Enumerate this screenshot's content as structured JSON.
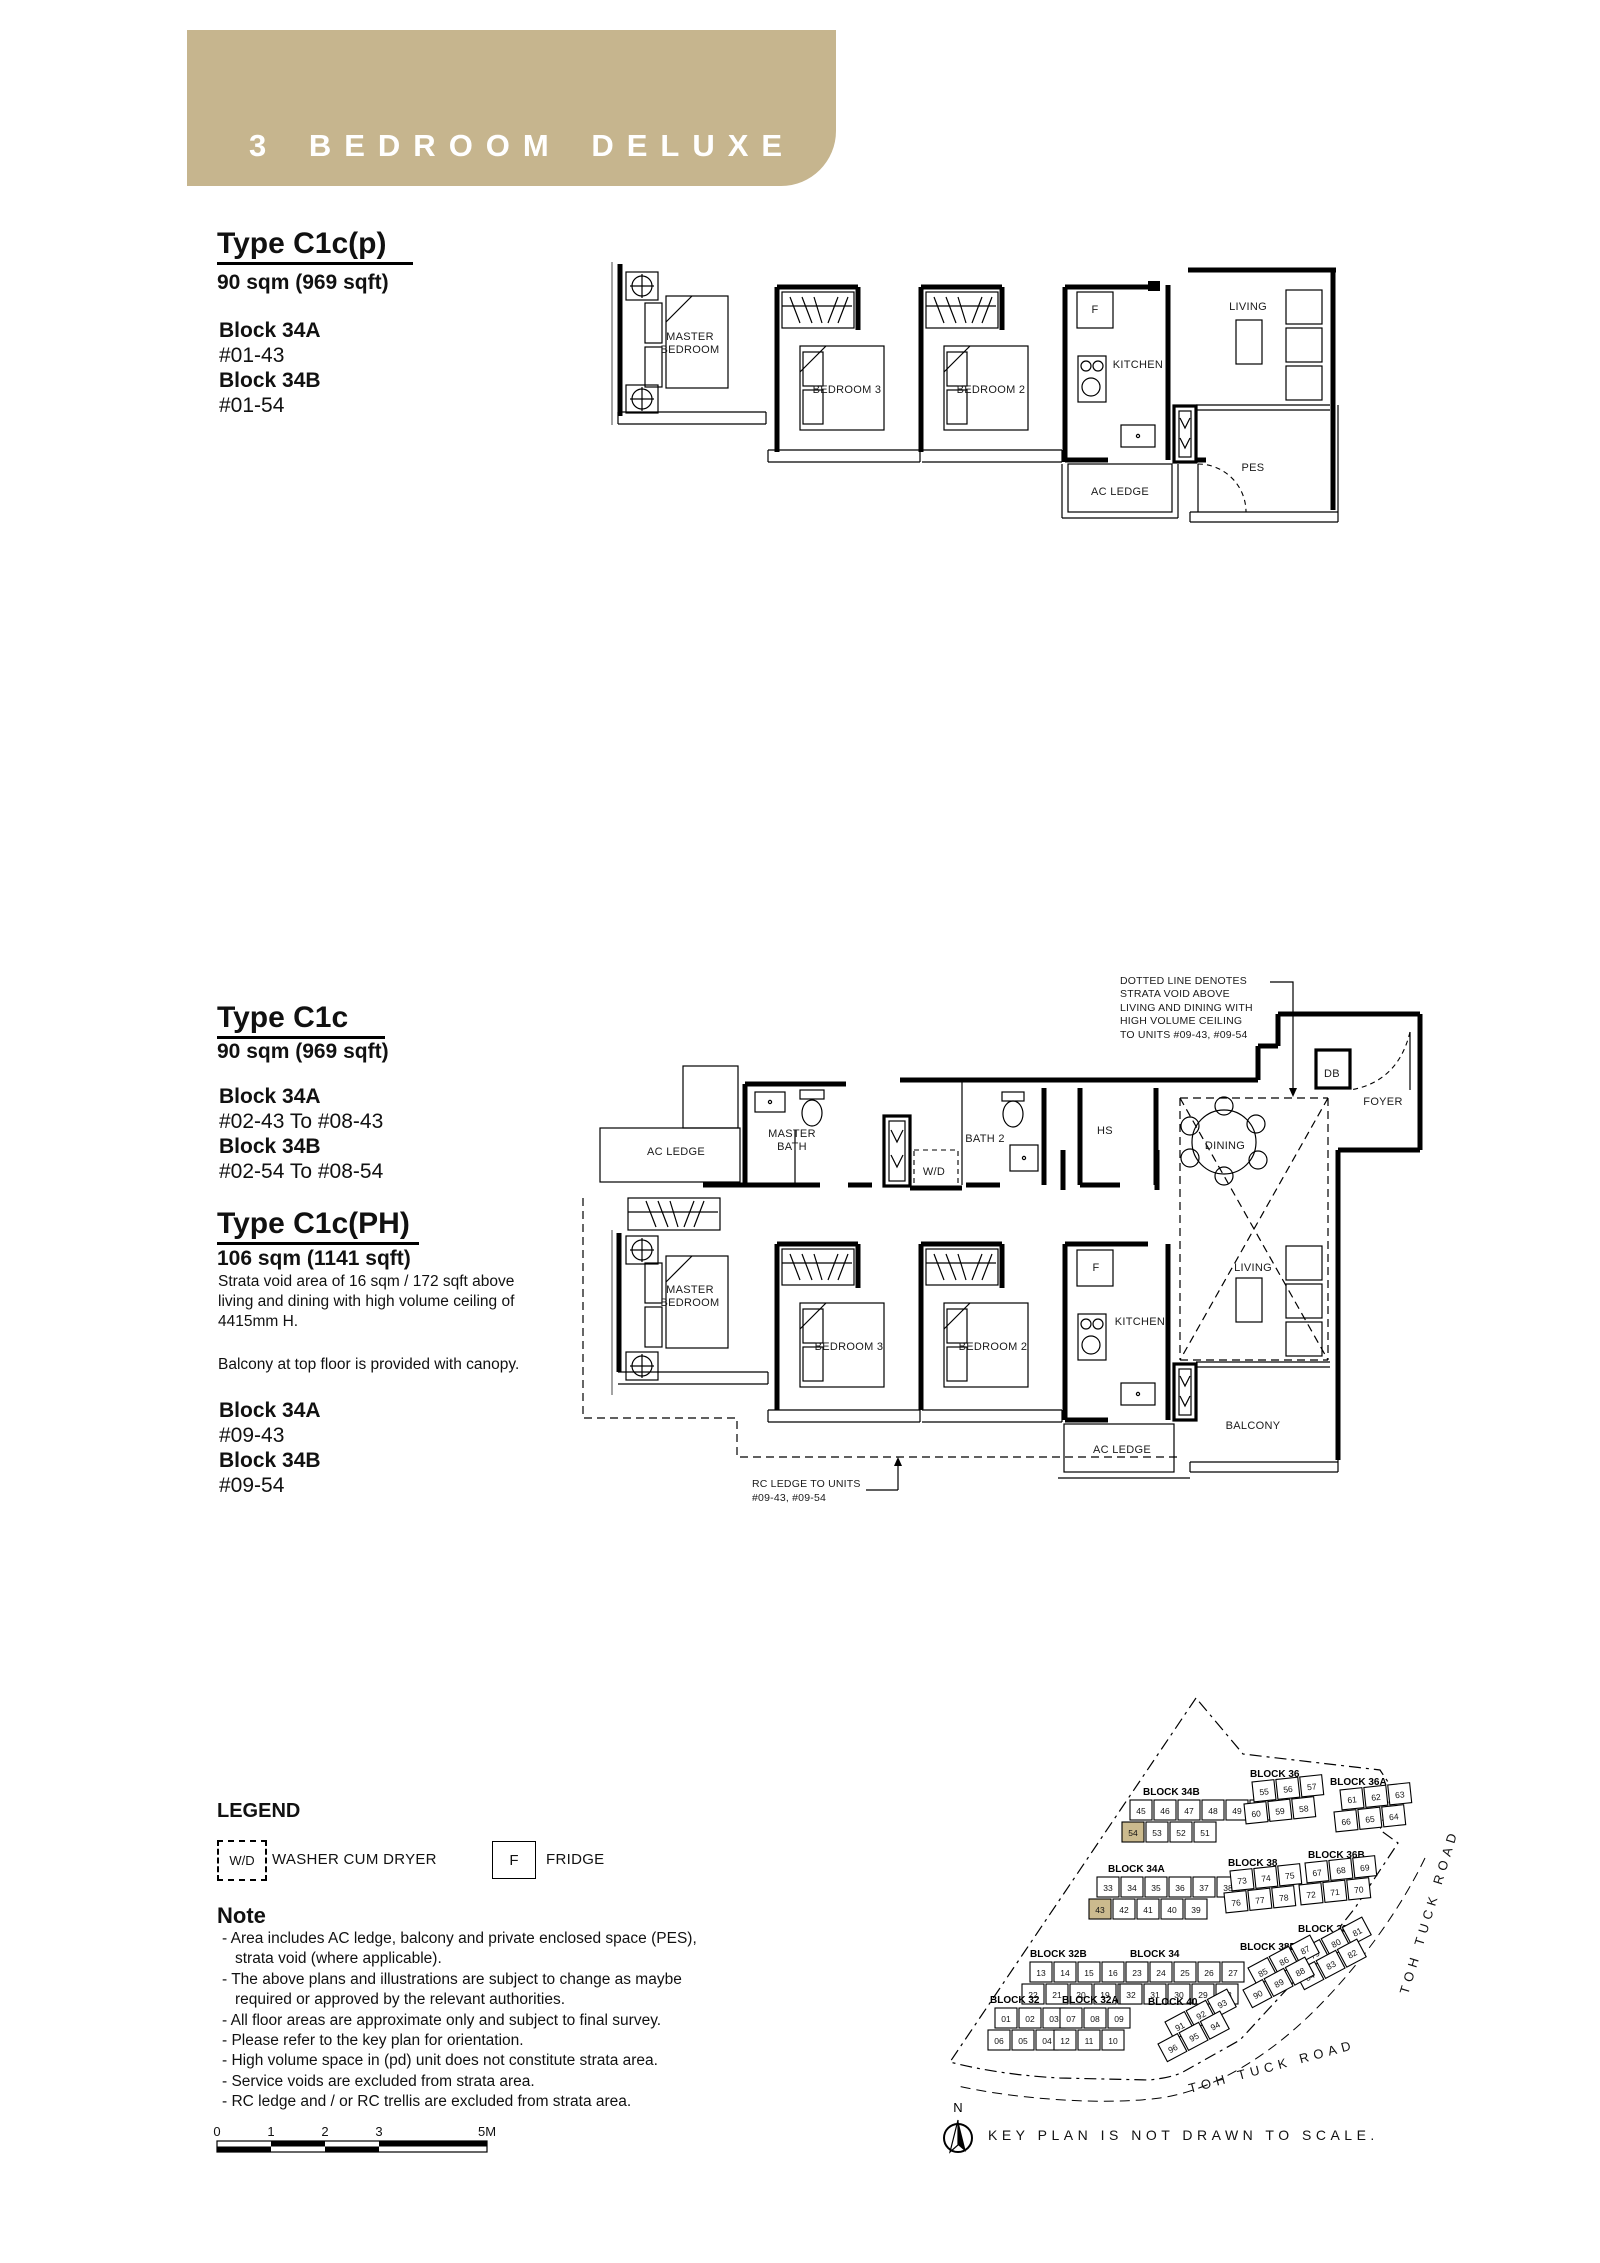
{
  "banner": {
    "title": "3 BEDROOM DELUXE"
  },
  "colors": {
    "banner": "#c6b58e",
    "highlight": "#cbba8e"
  },
  "unit_c1cp": {
    "title": "Type C1c(p)",
    "area": "90 sqm (969 sqft)",
    "stack": [
      {
        "block": "Block 34A",
        "units": "#01-43"
      },
      {
        "block": "Block 34B",
        "units": "#01-54"
      }
    ]
  },
  "unit_c1c": {
    "title": "Type C1c",
    "area": "90 sqm (969 sqft)",
    "stack": [
      {
        "block": "Block 34A",
        "units": "#02-43 To #08-43"
      },
      {
        "block": "Block 34B",
        "units": "#02-54 To #08-54"
      }
    ]
  },
  "unit_c1cph": {
    "title": "Type C1c(PH)",
    "area": "106 sqm (1141 sqft)",
    "desc": [
      "Strata void area of 16 sqm / 172 sqft above",
      "living and dining with high volume ceiling of",
      "4415mm H."
    ],
    "canopy_note": "Balcony at top floor is provided with canopy.",
    "stack": [
      {
        "block": "Block 34A",
        "units": "#09-43"
      },
      {
        "block": "Block 34B",
        "units": "#09-54"
      }
    ]
  },
  "plan1": {
    "labels": {
      "master_bedroom": "MASTER BEDROOM",
      "bedroom3": "BEDROOM 3",
      "bedroom2": "BEDROOM 2",
      "fridge": "F",
      "kitchen": "KITCHEN",
      "living": "LIVING",
      "pes": "PES",
      "ac_ledge": "AC LEDGE"
    }
  },
  "plan2": {
    "labels": {
      "ac_ledge_top": "AC LEDGE",
      "master_bath": "MASTER BATH",
      "wd": "W/D",
      "bath2": "BATH 2",
      "hs": "HS",
      "dining": "DINING",
      "db": "DB",
      "foyer": "FOYER",
      "master_bedroom": "MASTER BEDROOM",
      "bedroom3": "BEDROOM 3",
      "bedroom2": "BEDROOM 2",
      "fridge": "F",
      "kitchen": "KITCHEN",
      "living": "LIVING",
      "balcony": "BALCONY",
      "ac_ledge_bottom": "AC LEDGE"
    },
    "strata_note": [
      "DOTTED LINE DENOTES",
      "STRATA VOID ABOVE",
      "LIVING AND DINING WITH",
      "HIGH VOLUME CEILING",
      "TO UNITS #09-43, #09-54"
    ],
    "rc_note": [
      "RC LEDGE TO UNITS",
      "#09-43, #09-54"
    ]
  },
  "legend": {
    "title": "LEGEND",
    "wd_symbol": "W/D",
    "wd_label": "WASHER CUM DRYER",
    "f_symbol": "F",
    "f_label": "FRIDGE"
  },
  "note": {
    "title": "Note",
    "lines": [
      "- Area includes AC ledge, balcony and private enclosed space (PES),",
      "strata void (where applicable).",
      "- The above plans and illustrations are subject to change as maybe",
      "required or approved by the relevant authorities.",
      "- All floor areas are approximate only and subject to final survey.",
      "- Please refer to the key plan for orientation.",
      "- High volume space in (pd) unit does not constitute strata area.",
      "- Service voids are excluded from strata area.",
      "- RC ledge and / or RC trellis are excluded from strata area."
    ]
  },
  "scalebar": {
    "ticks": [
      "0",
      "1",
      "2",
      "3",
      "5M"
    ]
  },
  "keyplan": {
    "north": "N",
    "caption": "KEY PLAN IS NOT DRAWN TO SCALE.",
    "road_bottom": "TOH TUCK ROAD",
    "road_right": "TOH TUCK ROAD",
    "blocks": [
      {
        "name": "BLOCK 34B",
        "units": [
          [
            "45",
            "46",
            "47",
            "48",
            "49",
            "50"
          ],
          [
            "54",
            "53",
            "52",
            "51"
          ]
        ],
        "highlight": [
          "54"
        ]
      },
      {
        "name": "BLOCK 36",
        "units": [
          [
            "55",
            "56",
            "57"
          ],
          [
            "60",
            "59",
            "58"
          ]
        ]
      },
      {
        "name": "BLOCK 36A",
        "units": [
          [
            "61",
            "62",
            "63"
          ],
          [
            "66",
            "65",
            "64"
          ]
        ]
      },
      {
        "name": "BLOCK 34A",
        "units": [
          [
            "33",
            "34",
            "35",
            "36",
            "37",
            "38"
          ],
          [
            "43",
            "42",
            "41",
            "40",
            "39"
          ]
        ],
        "highlight": [
          "43"
        ]
      },
      {
        "name": "BLOCK 38",
        "units": [
          [
            "73",
            "74",
            "75"
          ],
          [
            "76",
            "77",
            "78"
          ]
        ]
      },
      {
        "name": "BLOCK 36B",
        "units": [
          [
            "67",
            "68",
            "69"
          ],
          [
            "72",
            "71",
            "70"
          ]
        ]
      },
      {
        "name": "BLOCK 32B",
        "units": [
          [
            "13",
            "14",
            "15",
            "16",
            "17"
          ],
          [
            "22",
            "21",
            "20",
            "19",
            "18"
          ]
        ]
      },
      {
        "name": "BLOCK 34",
        "units": [
          [
            "23",
            "24",
            "25",
            "26",
            "27"
          ],
          [
            "32",
            "31",
            "30",
            "29",
            "28"
          ]
        ]
      },
      {
        "name": "BLOCK 38A",
        "units": [
          [
            "79",
            "80",
            "81"
          ],
          [
            "84",
            "83",
            "82"
          ]
        ]
      },
      {
        "name": "BLOCK 38B",
        "units": [
          [
            "85",
            "86",
            "87"
          ],
          [
            "90",
            "89",
            "88"
          ]
        ]
      },
      {
        "name": "BLOCK 32",
        "units": [
          [
            "01",
            "02",
            "03"
          ],
          [
            "06",
            "05",
            "04"
          ]
        ]
      },
      {
        "name": "BLOCK 32A",
        "units": [
          [
            "07",
            "08",
            "09"
          ],
          [
            "12",
            "11",
            "10"
          ]
        ]
      },
      {
        "name": "BLOCK 40",
        "units": [
          [
            "91",
            "92",
            "93"
          ],
          [
            "96",
            "95",
            "94"
          ]
        ]
      }
    ]
  }
}
